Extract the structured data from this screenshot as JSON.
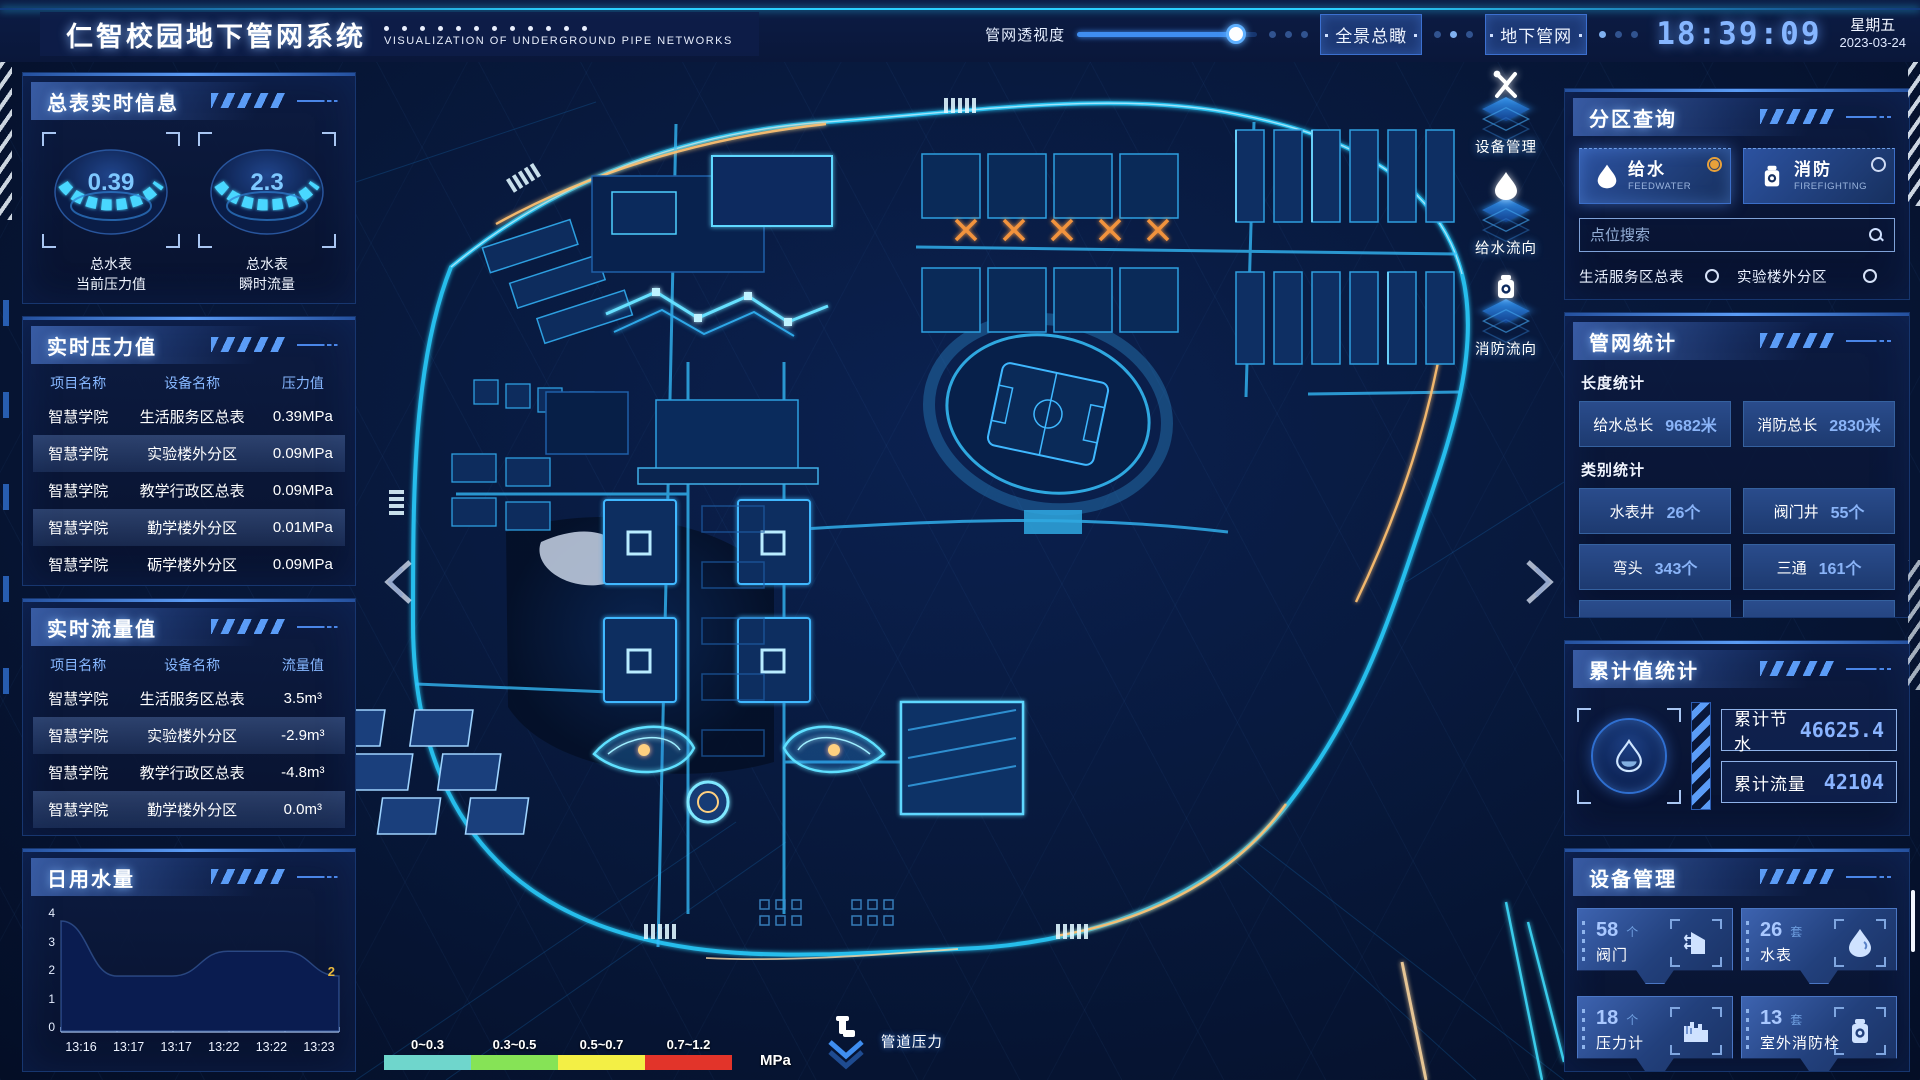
{
  "header": {
    "title": "仁智校园地下管网系统",
    "subtitle": "VISUALIZATION OF UNDERGROUND PIPE NETWORKS",
    "transparency_label": "管网透视度",
    "transparency_percent": 88,
    "btn_overview": "全景总瞰",
    "btn_underground": "地下管网",
    "time": "18:39:09",
    "weekday": "星期五",
    "date": "2023-03-24"
  },
  "left": {
    "meter": {
      "title": "总表实时信息",
      "gauges": [
        {
          "value": "0.39",
          "line1": "总水表",
          "line2": "当前压力值"
        },
        {
          "value": "2.3",
          "line1": "总水表",
          "line2": "瞬时流量"
        }
      ]
    },
    "pressure": {
      "title": "实时压力值",
      "headers": [
        "项目名称",
        "设备名称",
        "压力值"
      ],
      "rows": [
        [
          "智慧学院",
          "生活服务区总表",
          "0.39MPa"
        ],
        [
          "智慧学院",
          "实验楼外分区",
          "0.09MPa"
        ],
        [
          "智慧学院",
          "教学行政区总表",
          "0.09MPa"
        ],
        [
          "智慧学院",
          "勤学楼外分区",
          "0.01MPa"
        ],
        [
          "智慧学院",
          "砺学楼外分区",
          "0.09MPa"
        ]
      ]
    },
    "flow": {
      "title": "实时流量值",
      "headers": [
        "项目名称",
        "设备名称",
        "流量值"
      ],
      "rows": [
        [
          "智慧学院",
          "生活服务区总表",
          "3.5m³"
        ],
        [
          "智慧学院",
          "实验楼外分区",
          "-2.9m³"
        ],
        [
          "智慧学院",
          "教学行政区总表",
          "-4.8m³"
        ],
        [
          "智慧学院",
          "勤学楼外分区",
          "0.0m³"
        ],
        [
          "智慧学院",
          "砺学楼外分区",
          "2.3m³"
        ]
      ]
    },
    "daily_title": "日用水量"
  },
  "chart_data": {
    "type": "area",
    "title": "日用水量",
    "x": [
      "13:16",
      "13:17",
      "13:17",
      "13:22",
      "13:22",
      "13:23"
    ],
    "values": [
      4,
      2,
      2,
      2.9,
      2.9,
      2
    ],
    "yticks": [
      "0",
      "1",
      "2",
      "3",
      "4"
    ],
    "ylim": [
      0,
      4
    ],
    "end_label": "2",
    "grid": false,
    "fill_color": "#0a1c50"
  },
  "map": {
    "overlays": [
      {
        "icon": "wrench-icon",
        "label": "设备管理"
      },
      {
        "icon": "waterdrop-icon",
        "label": "给水流向"
      },
      {
        "icon": "hydrant-icon",
        "label": "消防流向"
      }
    ],
    "legend": {
      "ranges": [
        {
          "label": "0~0.3",
          "color": "#6fd6cc"
        },
        {
          "label": "0.3~0.5",
          "color": "#86e356"
        },
        {
          "label": "0.5~0.7",
          "color": "#f3ef45"
        },
        {
          "label": "0.7~1.2",
          "color": "#e2342a"
        }
      ],
      "unit": "MPa",
      "pressure_label": "管道压力"
    }
  },
  "right": {
    "zone": {
      "title": "分区查询",
      "feed": {
        "name": "给水",
        "en": "FEEDWATER"
      },
      "fire": {
        "name": "消防",
        "en": "FIREFIGHTING"
      },
      "search_placeholder": "点位搜索",
      "points": [
        "生活服务区总表",
        "实验楼外分区",
        "教学行政区总表",
        "勤学楼外分区",
        "砺学楼外分区",
        "宿舍区泵房"
      ]
    },
    "stats": {
      "title": "管网统计",
      "length_title": "长度统计",
      "type_title": "类别统计",
      "length": [
        {
          "label": "给水总长",
          "value": "9682米"
        },
        {
          "label": "消防总长",
          "value": "2830米"
        }
      ],
      "types": [
        {
          "label": "水表井",
          "value": "26个"
        },
        {
          "label": "阀门井",
          "value": "55个"
        },
        {
          "label": "弯头",
          "value": "343个"
        },
        {
          "label": "三通",
          "value": "161个"
        }
      ]
    },
    "totals": {
      "title": "累计值统计",
      "items": [
        {
          "label": "累计节水",
          "value": "46625.4"
        },
        {
          "label": "累计流量",
          "value": "42104"
        }
      ]
    },
    "devices": {
      "title": "设备管理",
      "cards": [
        {
          "count": "58",
          "unit": "个",
          "name": "阀门",
          "icon": "valve-icon"
        },
        {
          "count": "26",
          "unit": "套",
          "name": "水表",
          "icon": "water-meter-icon"
        },
        {
          "count": "18",
          "unit": "个",
          "name": "压力计",
          "icon": "pressure-gauge-icon"
        },
        {
          "count": "13",
          "unit": "套",
          "name": "室外消防栓",
          "icon": "outdoor-hydrant-icon"
        }
      ]
    }
  }
}
